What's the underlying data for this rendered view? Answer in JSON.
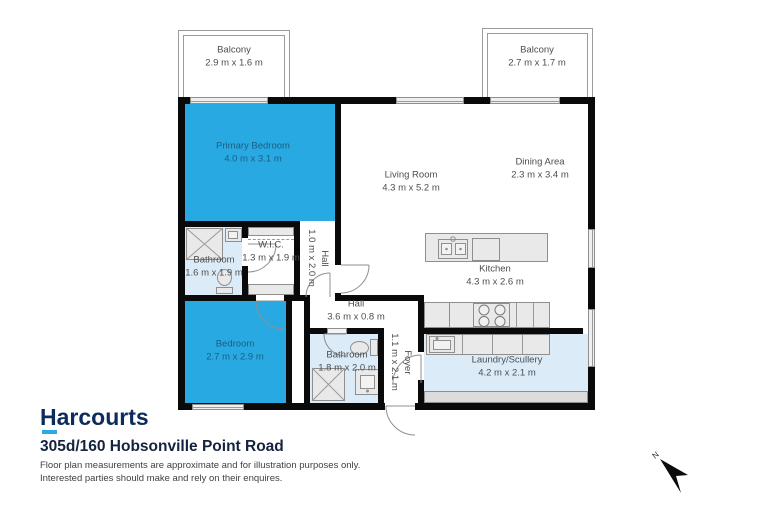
{
  "branding": {
    "logo_text": "Harcourts",
    "address": "305d/160 Hobsonville Point Road",
    "disclaimer_line1": "Floor plan measurements are approximate and for illustration purposes only.",
    "disclaimer_line2": "Interested parties should make and rely on their enquires."
  },
  "north_indicator": {
    "label": "N"
  },
  "colors": {
    "highlight_room_fill": "#29a9e1",
    "wet_area_fill": "#dbecf8",
    "wall": "#0a0a0a",
    "brand_navy": "#0d2b5c",
    "brand_cyan": "#2fa9e0",
    "label_text": "#4d4d4d"
  },
  "rooms": [
    {
      "name": "Balcony",
      "dims": "2.9 m x 1.6 m"
    },
    {
      "name": "Balcony",
      "dims": "2.7 m x 1.7 m"
    },
    {
      "name": "Primary Bedroom",
      "dims": "4.0 m x 3.1 m",
      "highlighted": true
    },
    {
      "name": "Living Room",
      "dims": "4.3 m x 5.2 m"
    },
    {
      "name": "Dining Area",
      "dims": "2.3 m x 3.4 m"
    },
    {
      "name": "Bathroom",
      "dims": "1.6 m x 1.9 m"
    },
    {
      "name": "W.I.C.",
      "dims": "1.3 m x 1.9 m"
    },
    {
      "name": "Hall",
      "dims": "1.0 m x 2.0 m"
    },
    {
      "name": "Bedroom",
      "dims": "2.7 m x 2.9 m",
      "highlighted": true
    },
    {
      "name": "Hall",
      "dims": "3.6 m x 0.8 m"
    },
    {
      "name": "Bathroom",
      "dims": "1.8 m x 2.0 m"
    },
    {
      "name": "Foyer",
      "dims": "1.1 m x 2.1 m"
    },
    {
      "name": "Kitchen",
      "dims": "4.3 m x 2.6 m"
    },
    {
      "name": "Laundry/Scullery",
      "dims": "4.2 m x 2.1 m"
    }
  ]
}
